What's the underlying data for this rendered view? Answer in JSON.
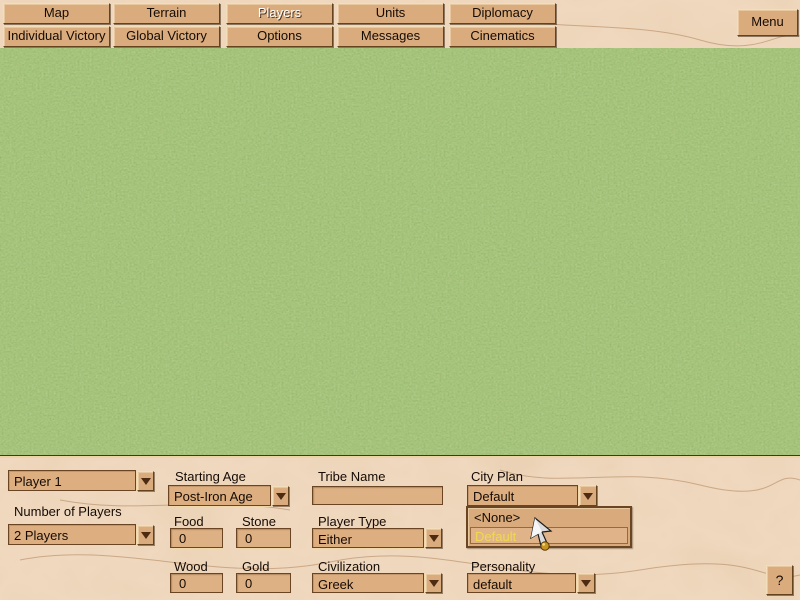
{
  "toolbar": {
    "tabs_row1": [
      "Map",
      "Terrain",
      "Players",
      "Units",
      "Diplomacy"
    ],
    "tabs_row2": [
      "Individual Victory",
      "Global Victory",
      "Options",
      "Messages",
      "Cinematics"
    ],
    "selected_tab": "Players",
    "menu_button": "Menu"
  },
  "player_panel": {
    "player_selector": "Player 1",
    "number_of_players_label": "Number of Players",
    "number_of_players": "2 Players",
    "starting_age_label": "Starting Age",
    "starting_age": "Post-Iron Age",
    "tribe_name_label": "Tribe Name",
    "tribe_name": "",
    "city_plan_label": "City Plan",
    "city_plan": "Default",
    "city_plan_dropdown": {
      "options": [
        "<None>",
        "Default"
      ],
      "highlighted": "Default"
    },
    "resources": {
      "food_label": "Food",
      "food": "0",
      "stone_label": "Stone",
      "stone": "0",
      "wood_label": "Wood",
      "wood": "0",
      "gold_label": "Gold",
      "gold": "0"
    },
    "player_type_label": "Player Type",
    "player_type": "Either",
    "civilization_label": "Civilization",
    "civilization": "Greek",
    "personality_label": "Personality",
    "personality": "default",
    "help_button": "?"
  },
  "colors": {
    "parchment": "#d7a77a",
    "field_face": "#dcae80",
    "bevel_highlight": "#f2debb",
    "bevel_shadow": "#64431f",
    "text": "#150b05",
    "selected_tab_text": "#ffffff",
    "grass_green": "#6b9444",
    "dropdown_highlight_text": "#eeda4e",
    "cursor_ball_gold": "#c89422"
  }
}
